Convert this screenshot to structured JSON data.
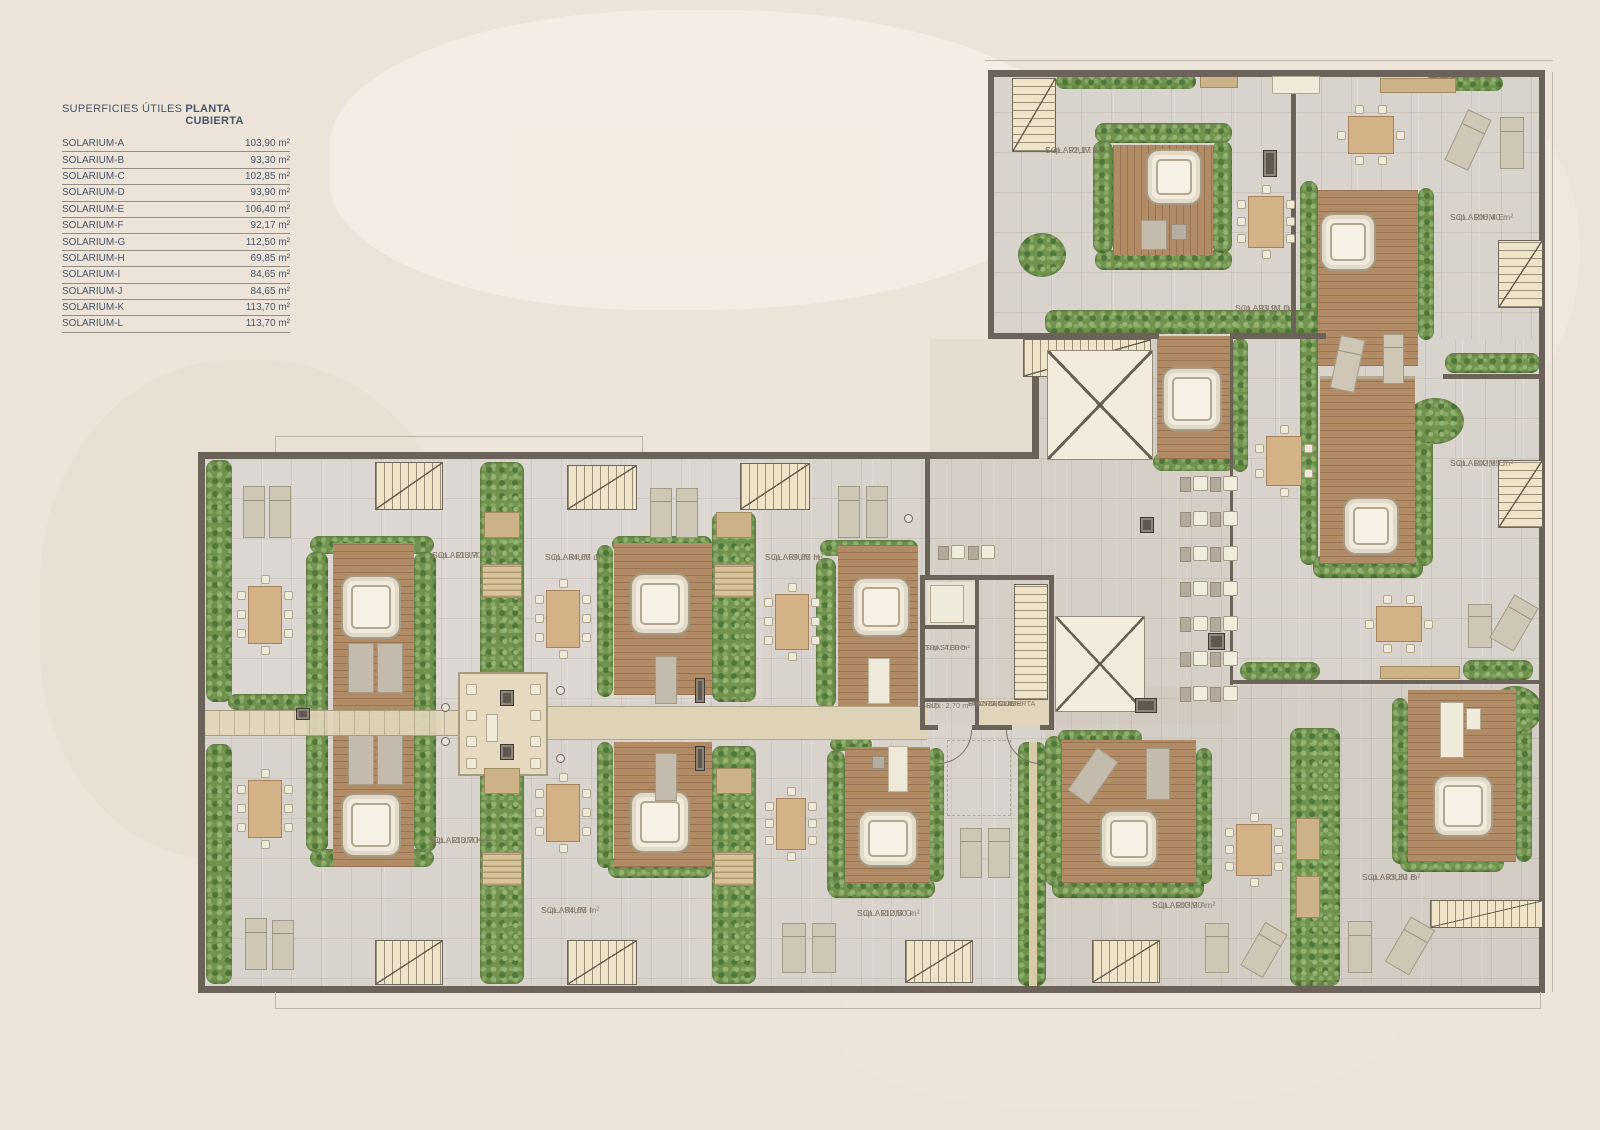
{
  "page": {
    "background": "#ece4d9"
  },
  "legend": {
    "title": "SUPERFICIES ÚTILES",
    "subtitle": "PLANTA CUBIERTA",
    "rows": [
      {
        "name": "SOLARIUM-A",
        "value": "103,90 m²"
      },
      {
        "name": "SOLARIUM-B",
        "value": "93,30 m²"
      },
      {
        "name": "SOLARIUM-C",
        "value": "102,85 m²"
      },
      {
        "name": "SOLARIUM-D",
        "value": "93,90 m²"
      },
      {
        "name": "SOLARIUM-E",
        "value": "106,40 m²"
      },
      {
        "name": "SOLARIUM-F",
        "value": "92,17 m²"
      },
      {
        "name": "SOLARIUM-G",
        "value": "112,50 m²"
      },
      {
        "name": "SOLARIUM-H",
        "value": "69,85 m²"
      },
      {
        "name": "SOLARIUM-I",
        "value": "84,65 m²"
      },
      {
        "name": "SOLARIUM-J",
        "value": "84,65 m²"
      },
      {
        "name": "SOLARIUM-K",
        "value": "113,70 m²"
      },
      {
        "name": "SOLARIUM-L",
        "value": "113,70 m²"
      }
    ]
  },
  "plan": {
    "units": [
      {
        "id": "A",
        "name": "SOLARIUM A",
        "sup": "Sup.: 103,90 m²"
      },
      {
        "id": "B",
        "name": "SOLARIUM B",
        "sup": "Sup.: 93,30 m²"
      },
      {
        "id": "C",
        "name": "SOLARIUM C",
        "sup": "Sup.: 102,85 m²"
      },
      {
        "id": "D",
        "name": "SOLARIUM D",
        "sup": "Sup.: 93,90 m²"
      },
      {
        "id": "E",
        "name": "SOLARIUM E",
        "sup": "Sup.: 106,40 m²"
      },
      {
        "id": "F",
        "name": "SOLARIUM F",
        "sup": "Sup.: 92,17 m²"
      },
      {
        "id": "G",
        "name": "SOLARIUM G",
        "sup": "Sup.: 112,50 m²"
      },
      {
        "id": "H",
        "name": "SOLARIUM H",
        "sup": "Sup.: 69,85 m²"
      },
      {
        "id": "I",
        "name": "SOLARIUM I",
        "sup": "Sup.: 84,65 m²"
      },
      {
        "id": "J",
        "name": "SOLARIUM J",
        "sup": "Sup.: 84,65 m²"
      },
      {
        "id": "K",
        "name": "SOLARIUM K",
        "sup": "Sup.: 113,70 m²"
      },
      {
        "id": "L",
        "name": "SOLARIUM L",
        "sup": "Sup.: 113,70 m²"
      }
    ],
    "rooms": [
      {
        "id": "trastero",
        "name": "TRASTERO",
        "sup": "Sup.: 4,30 m²"
      },
      {
        "id": "riti",
        "name": "RITI",
        "sup": "Sup.: 2,70 m²"
      },
      {
        "id": "distribuidor",
        "name": "DISTRIBUIDOR",
        "name2": "PLANTA CUBIERTA",
        "sup": "Sup.: 11,60 m²"
      }
    ]
  },
  "colors": {
    "accent_navy": "#44536a",
    "wall": "#6b6359",
    "wood_deck": "#b18a66",
    "hedge_green": "#72934f",
    "tile": "#d8d3cd",
    "walkway_tan": "#ded2b7",
    "background": "#ece4d9"
  }
}
